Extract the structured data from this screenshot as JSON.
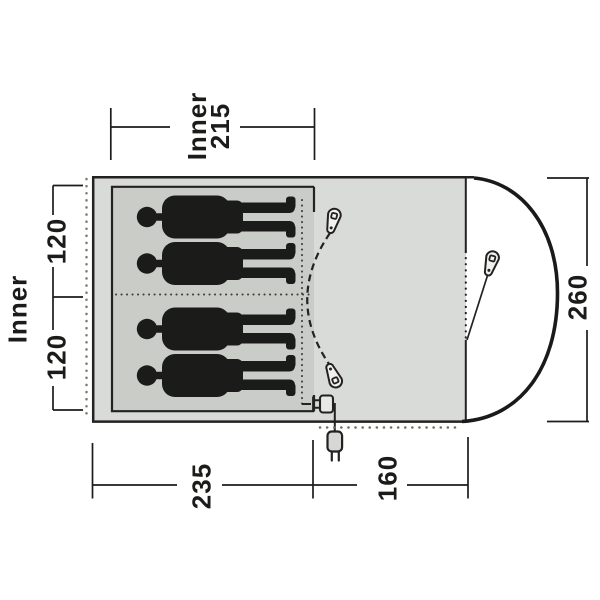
{
  "diagram": {
    "kind": "tent-floorplan-dimension-drawing",
    "sleeper_count": 4
  },
  "labels": {
    "top_width": {
      "line1": "Inner",
      "line2": "215"
    },
    "left_depth": {
      "title": "Inner",
      "upper": "120",
      "lower": "120"
    },
    "right_height": "260",
    "bottom_inner_length": "235",
    "bottom_porch_length": "160"
  },
  "icons": {
    "zipper_pull": "zipper-pull-icon",
    "power_plug": "power-plug-icon"
  },
  "colors": {
    "tent_fill": "#d9dbd8",
    "inner_cabin_fill": "#caccc8",
    "silhouette": "#1b1b19",
    "outline": "#232221",
    "dotted_light": "#7c7b74"
  }
}
